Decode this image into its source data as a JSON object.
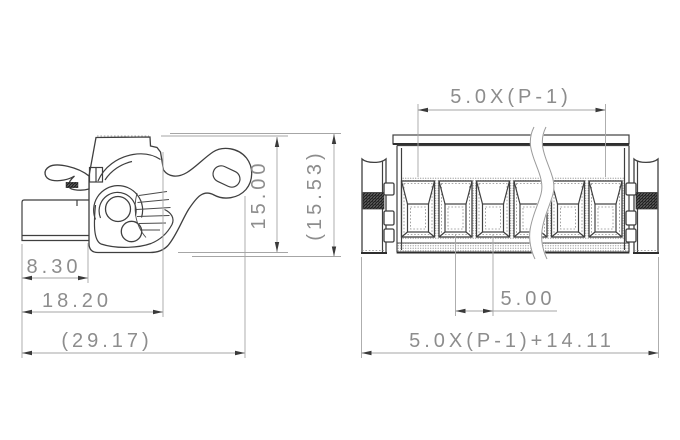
{
  "drawing": {
    "type": "technical-dimension-drawing",
    "part": "pluggable terminal block connector, side view and front view with break line",
    "side_view": {
      "dims": {
        "block_depth": "8.30",
        "body_depth": "18.20",
        "overall_depth": "(29.17)",
        "height": "15.00",
        "overall_height": "(15.53)"
      }
    },
    "front_view": {
      "poles_shown": 6,
      "dims": {
        "pole_span": "5.0X(P-1)",
        "pitch": "5.00",
        "overall_width": "5.0X(P-1)+14.11"
      }
    },
    "colors": {
      "outline": "#3f3f3f",
      "dimension_line": "#a6a6a6",
      "dimension_text": "#8d8d8d",
      "arrow": "#3a3a3a",
      "hatch": "#4f4f4f",
      "background": "#ffffff"
    }
  }
}
